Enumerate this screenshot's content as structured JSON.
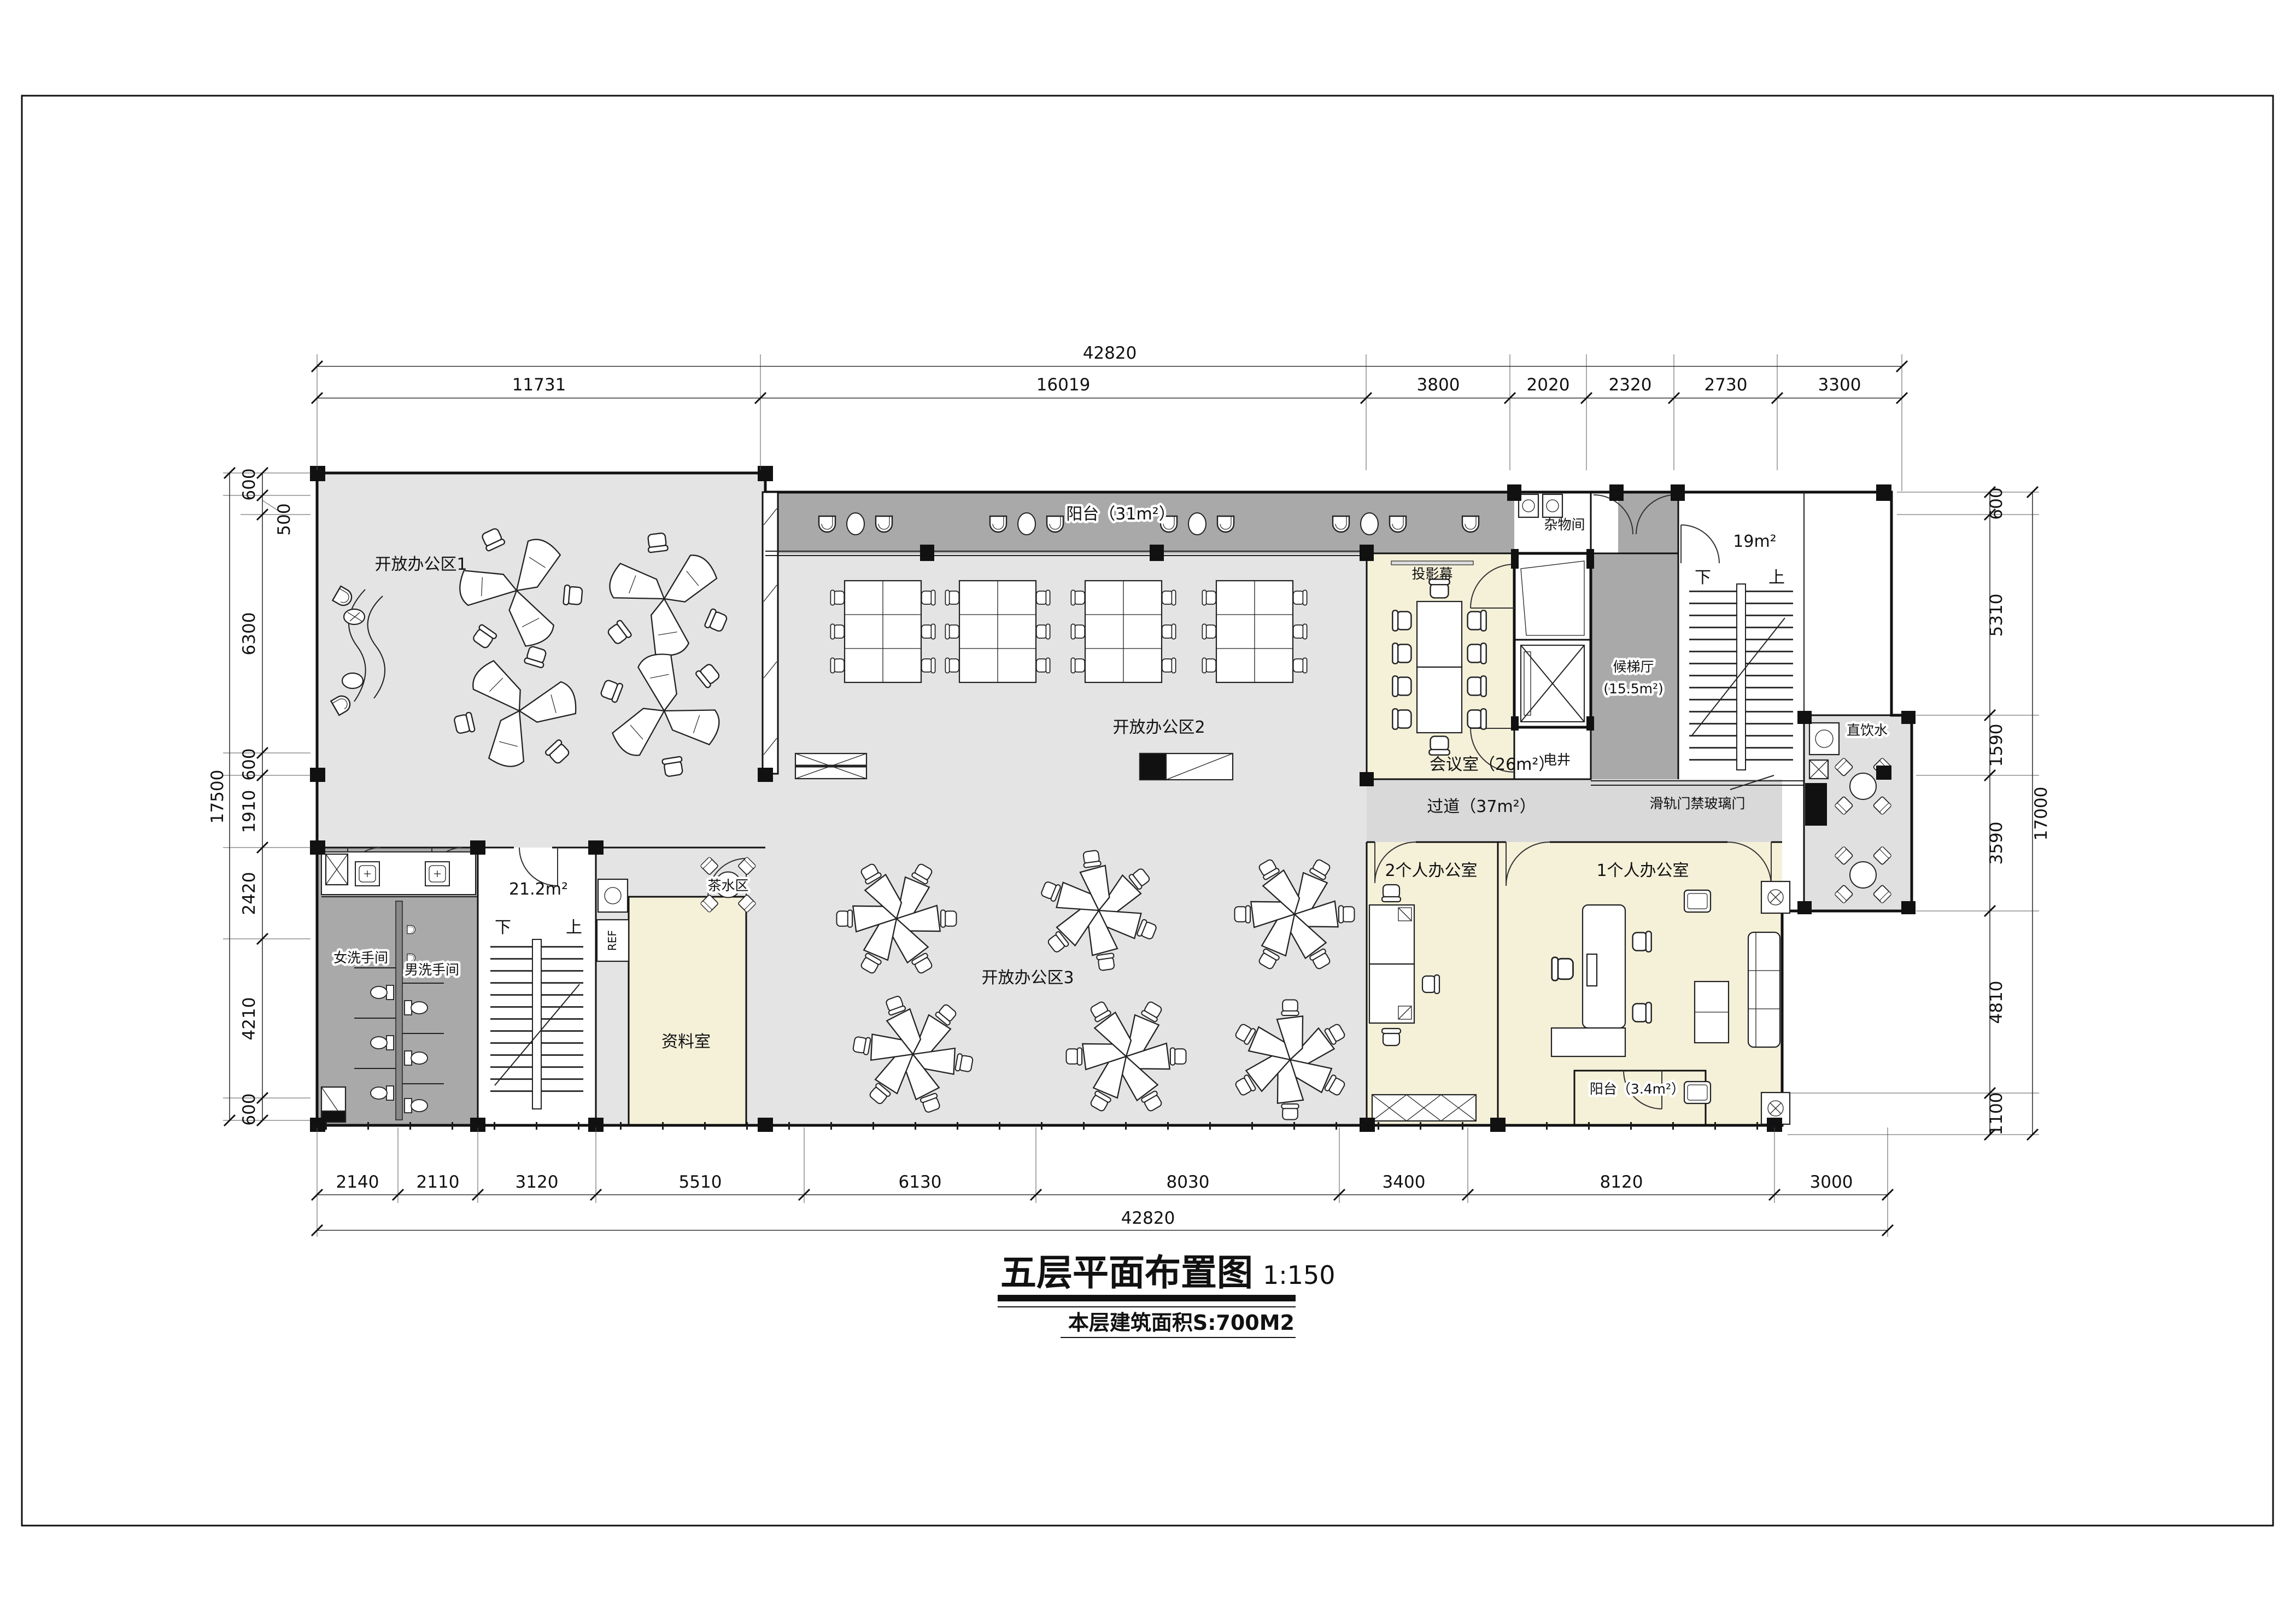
{
  "sheet": {
    "title": "五层平面布置图",
    "scale": "1:150",
    "subtitle": "本层建筑面积S:700M2"
  },
  "rooms": {
    "open_office_1": "开放办公区1",
    "open_office_2": "开放办公区2",
    "open_office_3": "开放办公区3",
    "balcony_top": "阳台（31m²）",
    "meeting_room": "会议室（26m²）",
    "projector_screen": "投影幕",
    "storage": "杂物间",
    "elevator_lobby_line1": "候梯厅",
    "elevator_lobby_line2": "(15.5m²)",
    "electrical_shaft": "电井",
    "stair_right_area": "19m²",
    "stair_down": "下",
    "stair_up": "上",
    "sliding_door": "滑轨门禁玻璃门",
    "corridor": "过道（37m²）",
    "drinking_water": "直饮水",
    "tea_area": "茶水区",
    "womens_restroom": "女洗手间",
    "mens_restroom": "男洗手间",
    "stair_left_area": "21.2m²",
    "archive": "资料室",
    "office_2p": "2个人办公室",
    "office_1p": "1个人办公室",
    "balcony_small": "阳台（3.4m²）",
    "fridge": "REF"
  },
  "dims": {
    "top_total": "42820",
    "top_segments": [
      "11731",
      "16019",
      "3800",
      "2020",
      "2320",
      "2730",
      "3300"
    ],
    "bottom_segments": [
      "2140",
      "2110",
      "3120",
      "5510",
      "6130",
      "8030",
      "3400",
      "8120",
      "3000"
    ],
    "bottom_total": "42820",
    "left_total": "17500",
    "left_segments": [
      "600",
      "500",
      "6300",
      "600",
      "1910",
      "2420",
      "4210",
      "600"
    ],
    "right_total": "17000",
    "right_segments": [
      "600",
      "5310",
      "1590",
      "3590",
      "4810",
      "1100"
    ]
  }
}
